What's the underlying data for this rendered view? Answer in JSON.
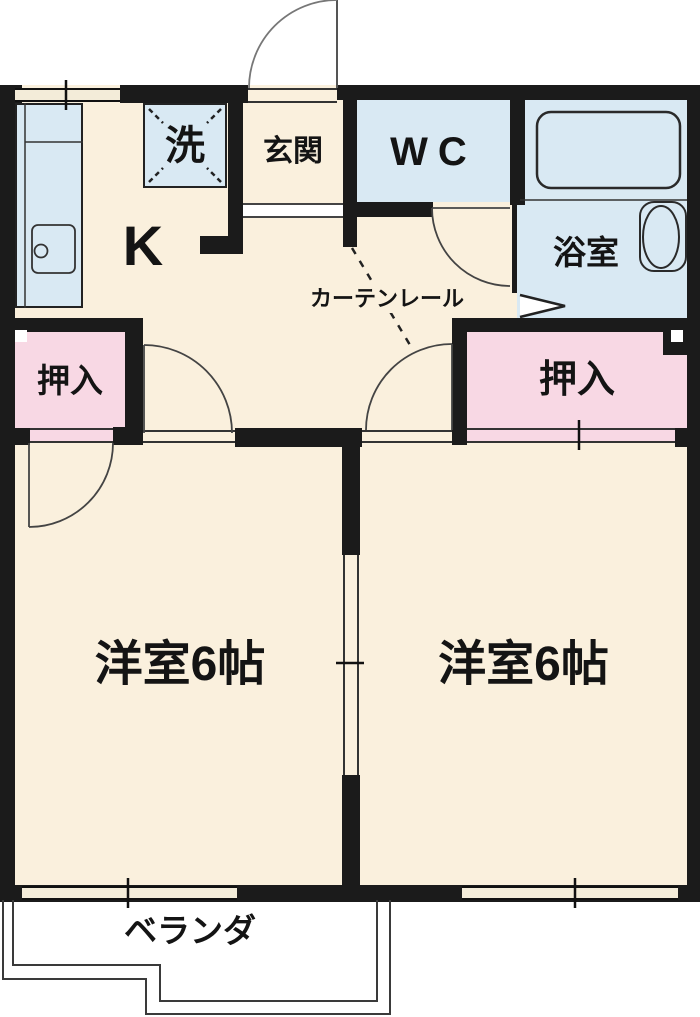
{
  "floorplan": {
    "labels": {
      "kitchen": "K",
      "entrance": "玄関",
      "wc": "WC",
      "bath": "浴室",
      "laundry": "洗",
      "closet_left": "押入",
      "closet_right": "押入",
      "room_left": "洋室6帖",
      "room_right": "洋室6帖",
      "veranda": "ベランダ",
      "curtain_rail": "カーテンレール"
    },
    "colors": {
      "floor": "#faf0dd",
      "water": "#d9e9f3",
      "closet": "#f8d8e4",
      "wall": "#1b1b1b",
      "line": "#3a3a3a",
      "step": "#ffffff"
    }
  }
}
